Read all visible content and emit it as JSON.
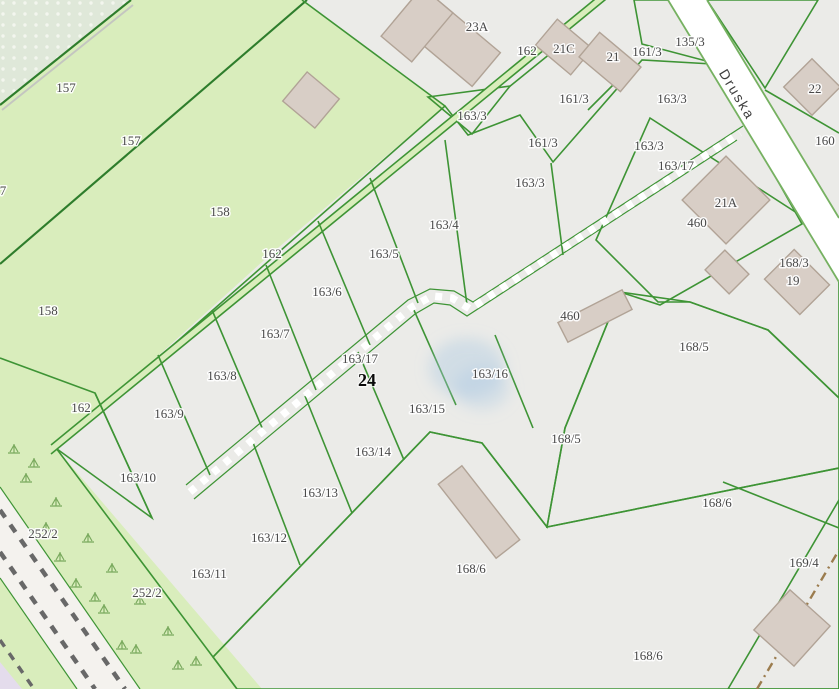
{
  "map": {
    "street_label": {
      "text": "Druska",
      "x": 733,
      "y": 97,
      "rotation": 59
    },
    "address_label": {
      "text": "24",
      "x": 367,
      "y": 386
    },
    "parcel_labels": [
      {
        "text": "157",
        "x": 66,
        "y": 92
      },
      {
        "text": "157",
        "x": 131,
        "y": 145
      },
      {
        "text": "158",
        "x": 220,
        "y": 216
      },
      {
        "text": "158",
        "x": 48,
        "y": 315
      },
      {
        "text": "7",
        "x": 3,
        "y": 195
      },
      {
        "text": "162",
        "x": 527,
        "y": 55
      },
      {
        "text": "162",
        "x": 272,
        "y": 258
      },
      {
        "text": "162",
        "x": 81,
        "y": 412
      },
      {
        "text": "23A",
        "x": 477,
        "y": 31
      },
      {
        "text": "21C",
        "x": 564,
        "y": 53
      },
      {
        "text": "21",
        "x": 613,
        "y": 61
      },
      {
        "text": "161/3",
        "x": 647,
        "y": 56
      },
      {
        "text": "161/3",
        "x": 574,
        "y": 103
      },
      {
        "text": "161/3",
        "x": 543,
        "y": 147
      },
      {
        "text": "135/3",
        "x": 690,
        "y": 46
      },
      {
        "text": "22",
        "x": 815,
        "y": 93
      },
      {
        "text": "160",
        "x": 825,
        "y": 145
      },
      {
        "text": "163/3",
        "x": 472,
        "y": 120
      },
      {
        "text": "163/3",
        "x": 530,
        "y": 187
      },
      {
        "text": "163/3",
        "x": 672,
        "y": 103
      },
      {
        "text": "163/3",
        "x": 649,
        "y": 150
      },
      {
        "text": "163/17",
        "x": 676,
        "y": 170
      },
      {
        "text": "163/17",
        "x": 360,
        "y": 363
      },
      {
        "text": "163/4",
        "x": 444,
        "y": 229
      },
      {
        "text": "163/5",
        "x": 384,
        "y": 258
      },
      {
        "text": "163/6",
        "x": 327,
        "y": 296
      },
      {
        "text": "163/7",
        "x": 275,
        "y": 338
      },
      {
        "text": "163/8",
        "x": 222,
        "y": 380
      },
      {
        "text": "163/9",
        "x": 169,
        "y": 418
      },
      {
        "text": "163/10",
        "x": 138,
        "y": 482
      },
      {
        "text": "163/11",
        "x": 209,
        "y": 578
      },
      {
        "text": "163/12",
        "x": 269,
        "y": 542
      },
      {
        "text": "163/13",
        "x": 320,
        "y": 497
      },
      {
        "text": "163/14",
        "x": 373,
        "y": 456
      },
      {
        "text": "163/15",
        "x": 427,
        "y": 413
      },
      {
        "text": "163/16",
        "x": 490,
        "y": 378
      },
      {
        "text": "460",
        "x": 570,
        "y": 320
      },
      {
        "text": "460",
        "x": 697,
        "y": 227
      },
      {
        "text": "21A",
        "x": 726,
        "y": 207
      },
      {
        "text": "168/3",
        "x": 794,
        "y": 267
      },
      {
        "text": "19",
        "x": 793,
        "y": 285
      },
      {
        "text": "168/5",
        "x": 694,
        "y": 351
      },
      {
        "text": "168/5",
        "x": 566,
        "y": 443
      },
      {
        "text": "168/6",
        "x": 471,
        "y": 573
      },
      {
        "text": "168/6",
        "x": 717,
        "y": 507
      },
      {
        "text": "168/6",
        "x": 648,
        "y": 660
      },
      {
        "text": "169/4",
        "x": 804,
        "y": 567
      },
      {
        "text": "252/2",
        "x": 43,
        "y": 538
      },
      {
        "text": "252/2",
        "x": 147,
        "y": 597
      }
    ],
    "colors": {
      "urban": "#ebebe8",
      "field": "#d9edbc",
      "farmland": "#c9c3b0",
      "dotted_base": "#dfe8d9",
      "boundary": "#3e9435",
      "boundary_dark": "#2e7d2c",
      "building_fill": "#d8cec6",
      "building_stroke": "#b1a396",
      "road_fill": "#ffffff",
      "road_casing": "#76b161",
      "rail_band": "#f4f2ee",
      "rail_dash": "#686868",
      "path_brown": "#9b7c4e",
      "lavender": "#e4dcec",
      "water_smudge": "#a9c8e2",
      "tuft": "#79a95d",
      "label_color": "#484848",
      "street_color": "#3e3e3e",
      "address_color": "#0a0a0a"
    }
  }
}
